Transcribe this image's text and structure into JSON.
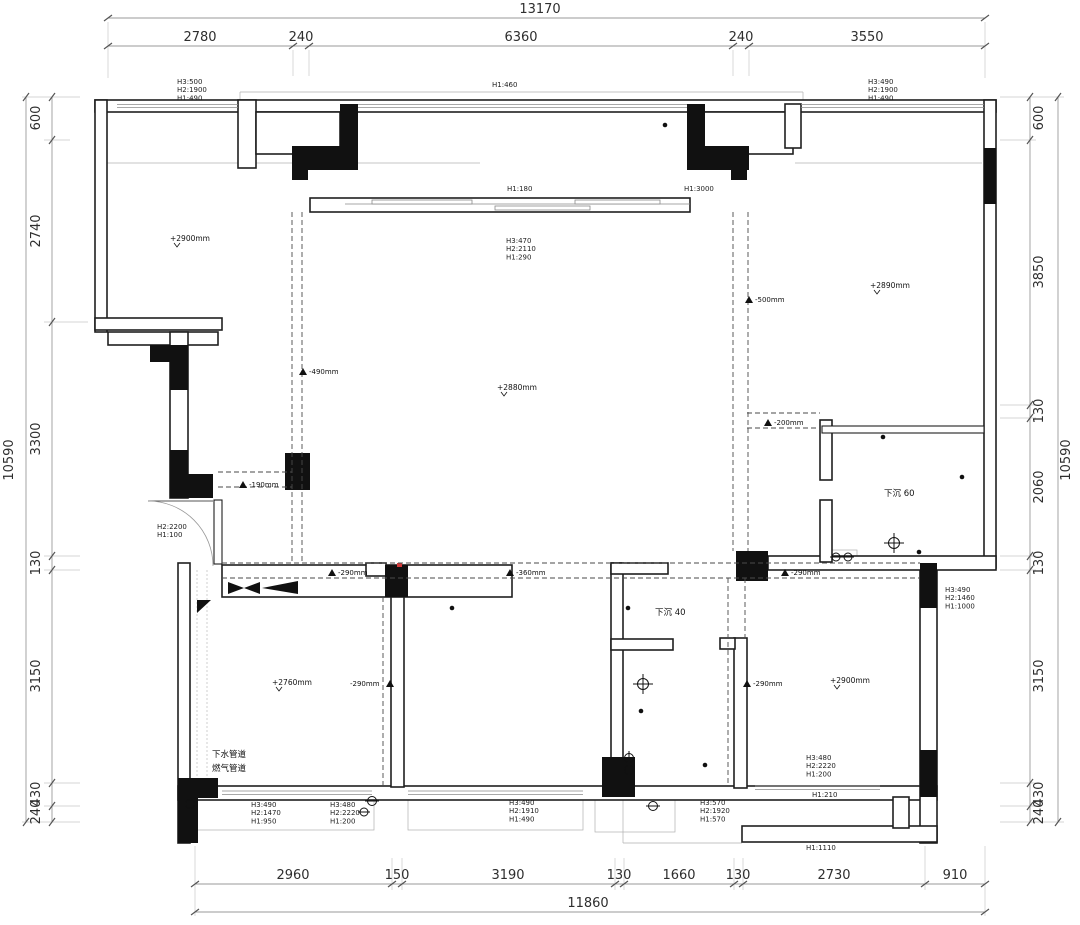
{
  "dims": {
    "top": {
      "total": "13170",
      "segs": [
        "2780",
        "240",
        "6360",
        "240",
        "3550"
      ]
    },
    "bottom": {
      "total": "11860",
      "segs": [
        "2960",
        "150",
        "3190",
        "130",
        "1660",
        "130",
        "2730",
        "910"
      ]
    },
    "left": {
      "total": "10590",
      "segs": [
        "600",
        "2740",
        "3300",
        "130",
        "3150",
        "430",
        "240"
      ]
    },
    "right": {
      "total": "10590",
      "segs": [
        "600",
        "3850",
        "130",
        "2060",
        "130",
        "3150",
        "430",
        "240"
      ]
    }
  },
  "labels": {
    "top_left_beam": [
      "H3:500",
      "H2:1900",
      "H1:490"
    ],
    "top_center_beam": "H1:460",
    "top_right_beam": [
      "H3:490",
      "H2:1900",
      "H1:490"
    ],
    "balcony_beam": "H1:180",
    "hall_opening": "H1:3000",
    "living_window": [
      "H3:470",
      "H2:2110",
      "H1:290"
    ],
    "entry_door": [
      "H2:2200",
      "H1:100"
    ],
    "kitchen_window": [
      "H3:490",
      "H2:1470",
      "H1:950"
    ],
    "kitchen_door": [
      "H3:480",
      "H2:2220",
      "H1:200"
    ],
    "bedroom1_window": [
      "H3:490",
      "H2:1910",
      "H1:490"
    ],
    "hall_door": [
      "H3:570",
      "H2:1920",
      "H1:570"
    ],
    "bedroom2_door": [
      "H3:480",
      "H2:2220",
      "H1:200"
    ],
    "bedroom2_sill": "H1:210",
    "right_window": [
      "H3:490",
      "H2:1460",
      "H1:1000"
    ],
    "bottom_right_beam": "H1:1110"
  },
  "levels": {
    "m1": "-490mm",
    "m2": "-500mm",
    "m3": "-200mm",
    "m4": "-190mm",
    "m5": "-290mm",
    "m6": "-360mm",
    "m7": "-290mm",
    "m8": "-290mm",
    "m9": "-290mm"
  },
  "ceilings": {
    "c1": "+2900mm",
    "c2": "+2890mm",
    "c3": "+2880mm",
    "c4": "+2760mm",
    "c5": "+2900mm"
  },
  "notes": {
    "sunken60": "下沉 60",
    "sunken40": "下沉 40",
    "drain": "下水管道",
    "gas": "燃气管道"
  },
  "colors": {
    "line": "#1f1f1f",
    "dim_line": "#9a9a9a",
    "dim_text": "#2e2e2e",
    "fill_black": "#111111",
    "accent_red": "#d43b3b",
    "bg": "#ffffff"
  }
}
